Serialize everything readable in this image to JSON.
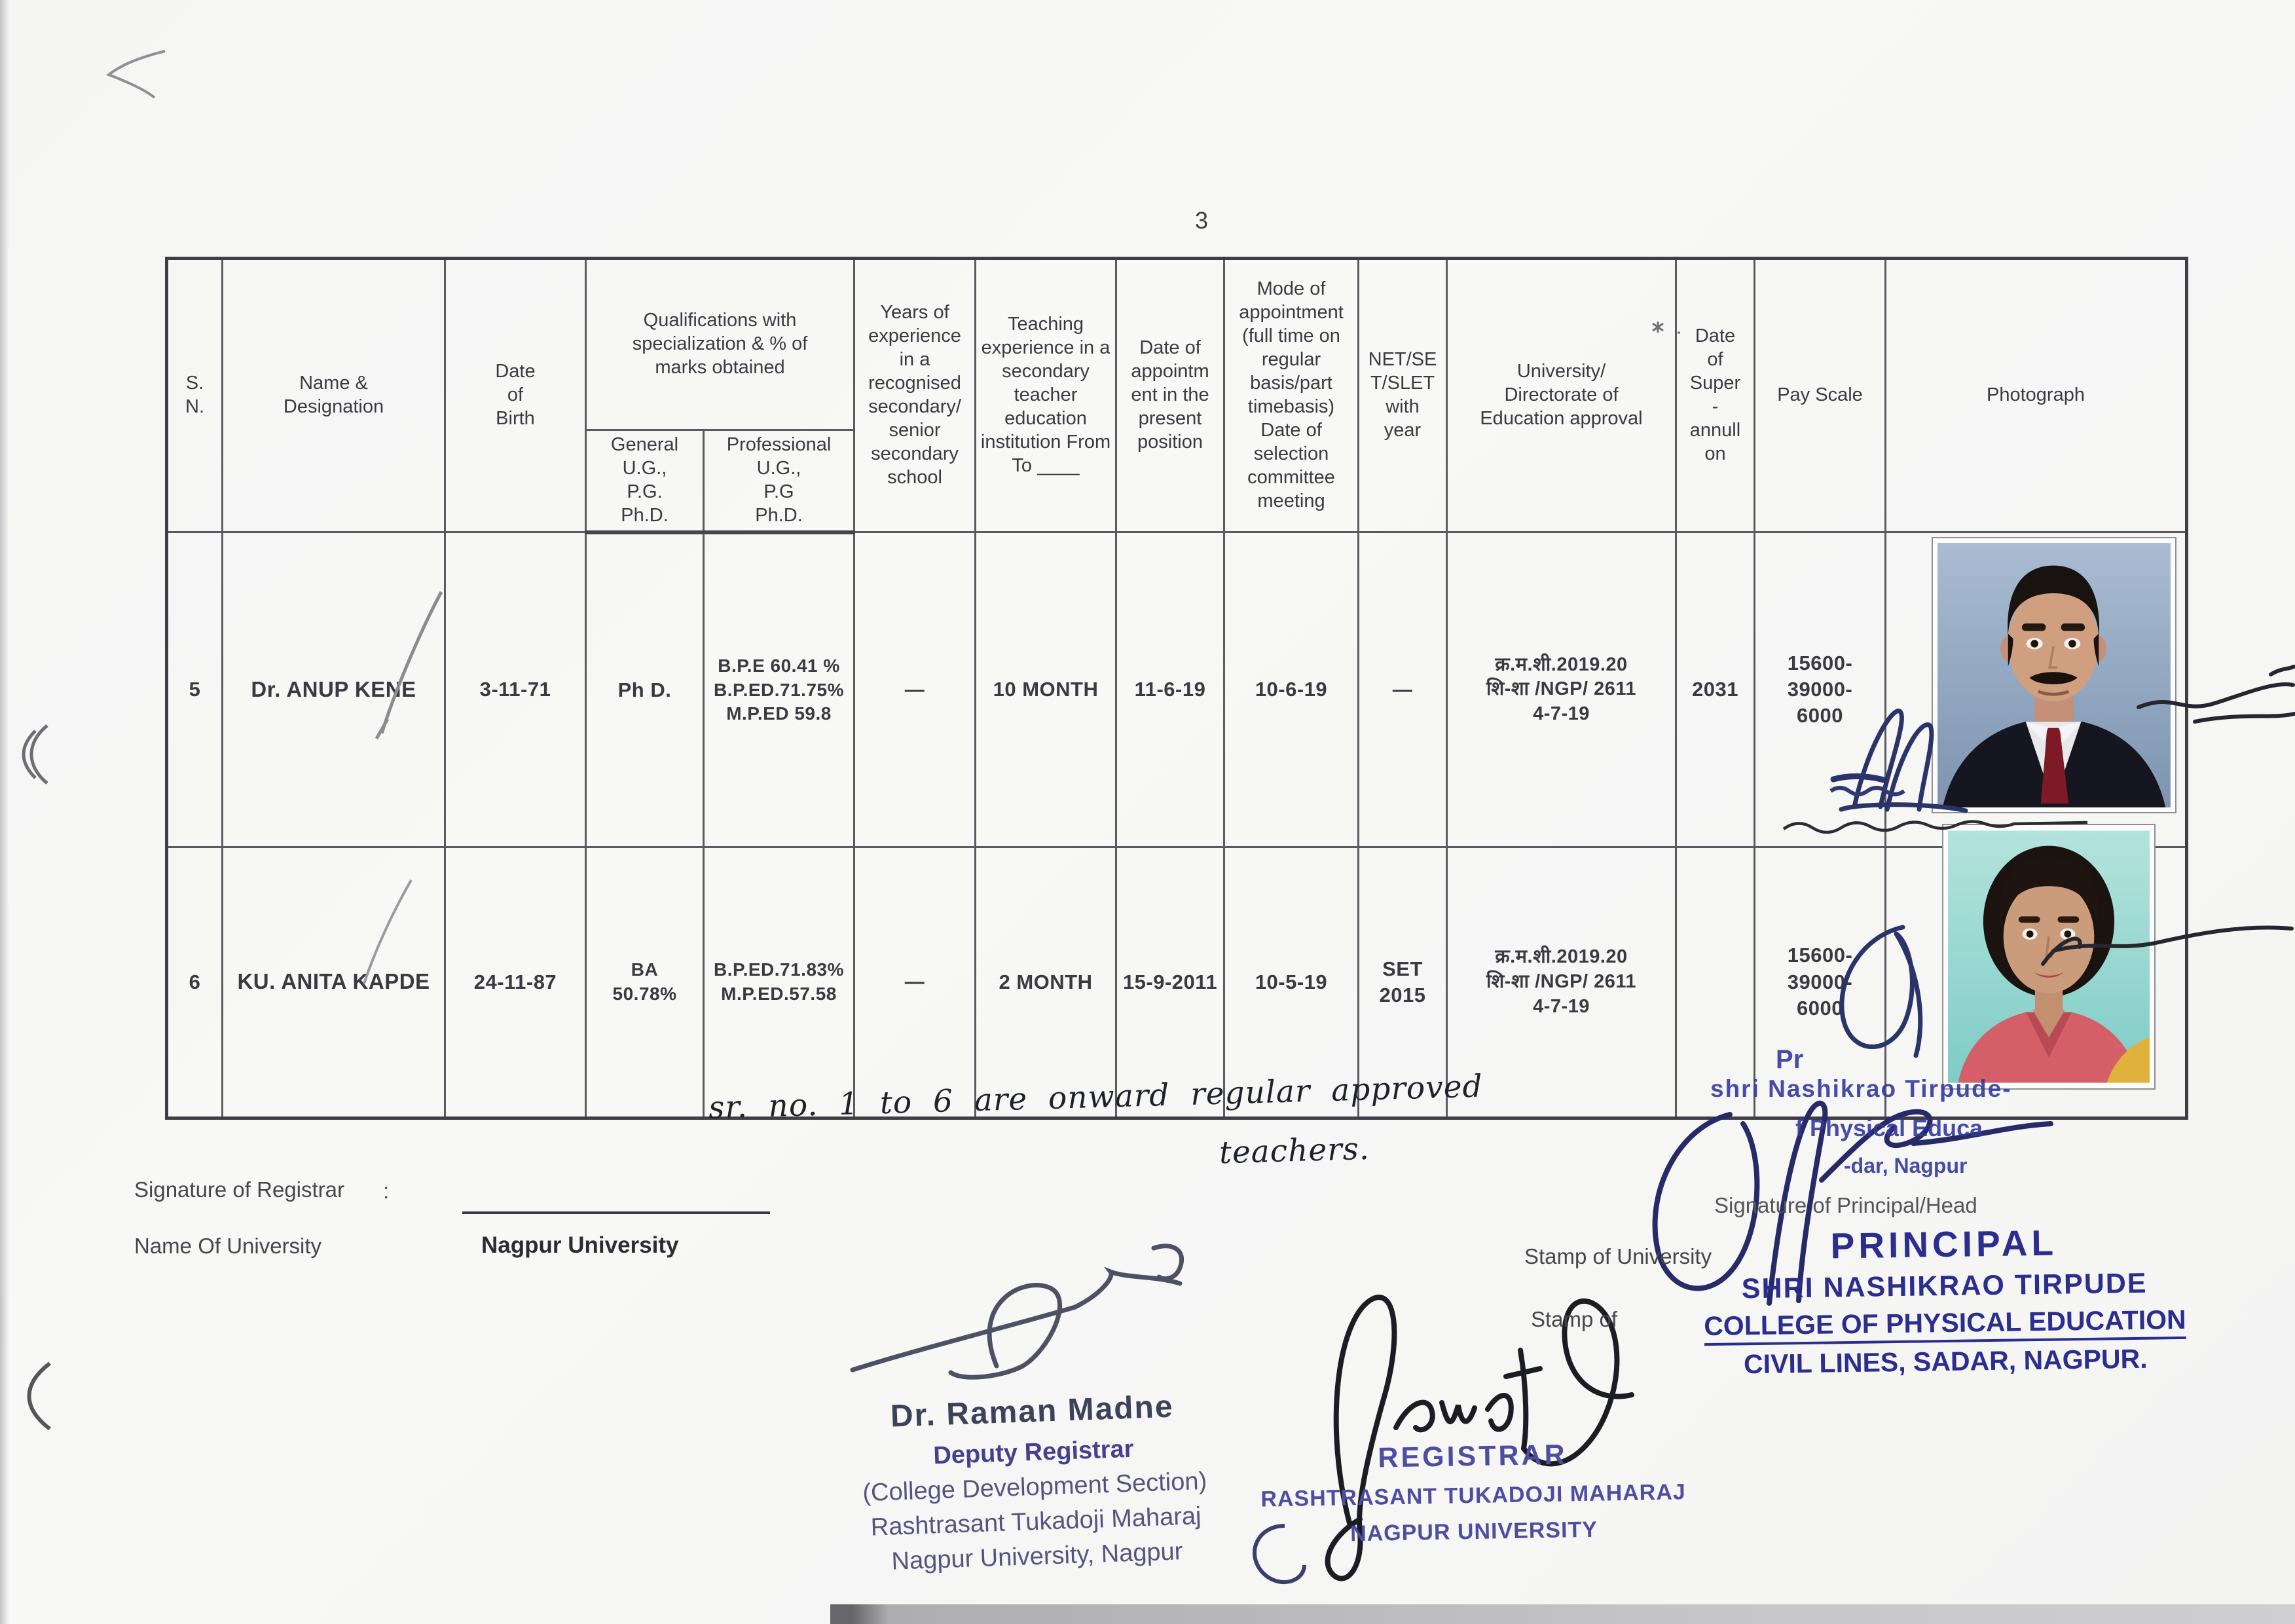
{
  "page": {
    "number": "3"
  },
  "colors": {
    "stamp_blue": "#2b2e8f",
    "deputy_stamp_purple": "#473f90",
    "ink_navy": "#262a66",
    "ink_black": "#1c1c24",
    "pencil_gray": "#8b8b90",
    "photo1_background": "#93a7bf",
    "photo2_background": "#8ed3cd"
  },
  "table": {
    "header": {
      "sn": "S.\nN.",
      "name": "Name &\nDesignation",
      "dob": "Date\nof\nBirth",
      "qualifications": "Qualifications with\nspecialization & % of\nmarks obtained",
      "general": "General\nU.G.,\nP.G.\nPh.D.",
      "professional": "Professional\nU.G.,\nP.G\nPh.D.",
      "years": "Years of\nexperience\nin a\nrecognised\nsecondary/\nsenior\nsecondary\nschool",
      "teaching": "Teaching\nexperience in a\nsecondary\nteacher\neducation\ninstitution From\nTo ____",
      "date_appt": "Date of\nappointm\nent in the\npresent\nposition",
      "mode": "Mode of\nappointment\n(full time on\nregular\nbasis/part\ntimebasis)\nDate of\nselection\ncommittee\nmeeting",
      "net": "NET/SE\nT/SLET\nwith\nyear",
      "university": "University/\nDirectorate of\nEducation approval",
      "superannuation": "Date\nof\nSuper\n-\nannull\non",
      "pay": "Pay Scale",
      "photo": "Photograph"
    },
    "rows": [
      {
        "sn": "5",
        "name": "Dr. ANUP KENE",
        "dob": "3-11-71",
        "general": "Ph D.",
        "professional": "B.P.E 60.41 %\nB.P.ED.71.75%\nM.P.ED 59.8",
        "years": "—",
        "teaching": "10 MONTH",
        "date_appt": "11-6-19",
        "mode": "10-6-19",
        "net": "—",
        "university": "क्र.म.शी.2019.20\nशि-शा /NGP/ 2611\n4-7-19",
        "superannuation": "2031",
        "pay": "15600-\n39000-\n6000",
        "photo": "man-in-dark-suit-portrait"
      },
      {
        "sn": "6",
        "name": "KU. ANITA KAPDE",
        "dob": "24-11-87",
        "general": "BA\n50.78%",
        "professional": "B.P.ED.71.83%\nM.P.ED.57.58",
        "years": "—",
        "teaching": "2 MONTH",
        "date_appt": "15-9-2011",
        "mode": "10-5-19",
        "net": "SET\n2015",
        "university": "क्र.म.शी.2019.20\nशि-शा /NGP/ 2611\n4-7-19",
        "superannuation": "",
        "pay": "15600-\n39000-\n6000",
        "photo": "woman-in-pink-top-portrait"
      }
    ]
  },
  "handwritten_note": {
    "line1": "sr. no. 1 to 6 are onward regular approved",
    "line2": "teachers."
  },
  "footer": {
    "registrar_sig_label": "Signature of Registrar",
    "registrar_sig_colon": ":",
    "university_label": "Name Of University",
    "university_value": "Nagpur University",
    "deputy_stamp": {
      "name": "Dr. Raman Madne",
      "title": "Deputy Registrar",
      "section": "(College Development Section)",
      "org_line1": "Rashtrasant Tukadoji Maharaj",
      "org_line2": "Nagpur University, Nagpur"
    },
    "registrar_stamp": {
      "title": "REGISTRAR",
      "org_line1": "RASHTRASANT TUKADOJI MAHARAJ",
      "org_line2": "NAGPUR UNIVERSITY"
    },
    "principal": {
      "sig_label": "Signature of Principal/Head",
      "stamp_of_university": "Stamp of University",
      "stamp_of": "Stamp of",
      "stamp_title": "PRINCIPAL",
      "stamp_line1": "SHRI NASHIKRAO TIRPUDE",
      "stamp_line2": "COLLEGE OF PHYSICAL EDUCATION",
      "stamp_line3": "CIVIL LINES, SADAR, NAGPUR."
    },
    "partial_stamp": {
      "fragment0": "Pr",
      "fragment1": "shri Nashikrao Tirpude-",
      "fragment2": "f Physical Educa",
      "fragment3": "-dar, Nagpur"
    }
  }
}
